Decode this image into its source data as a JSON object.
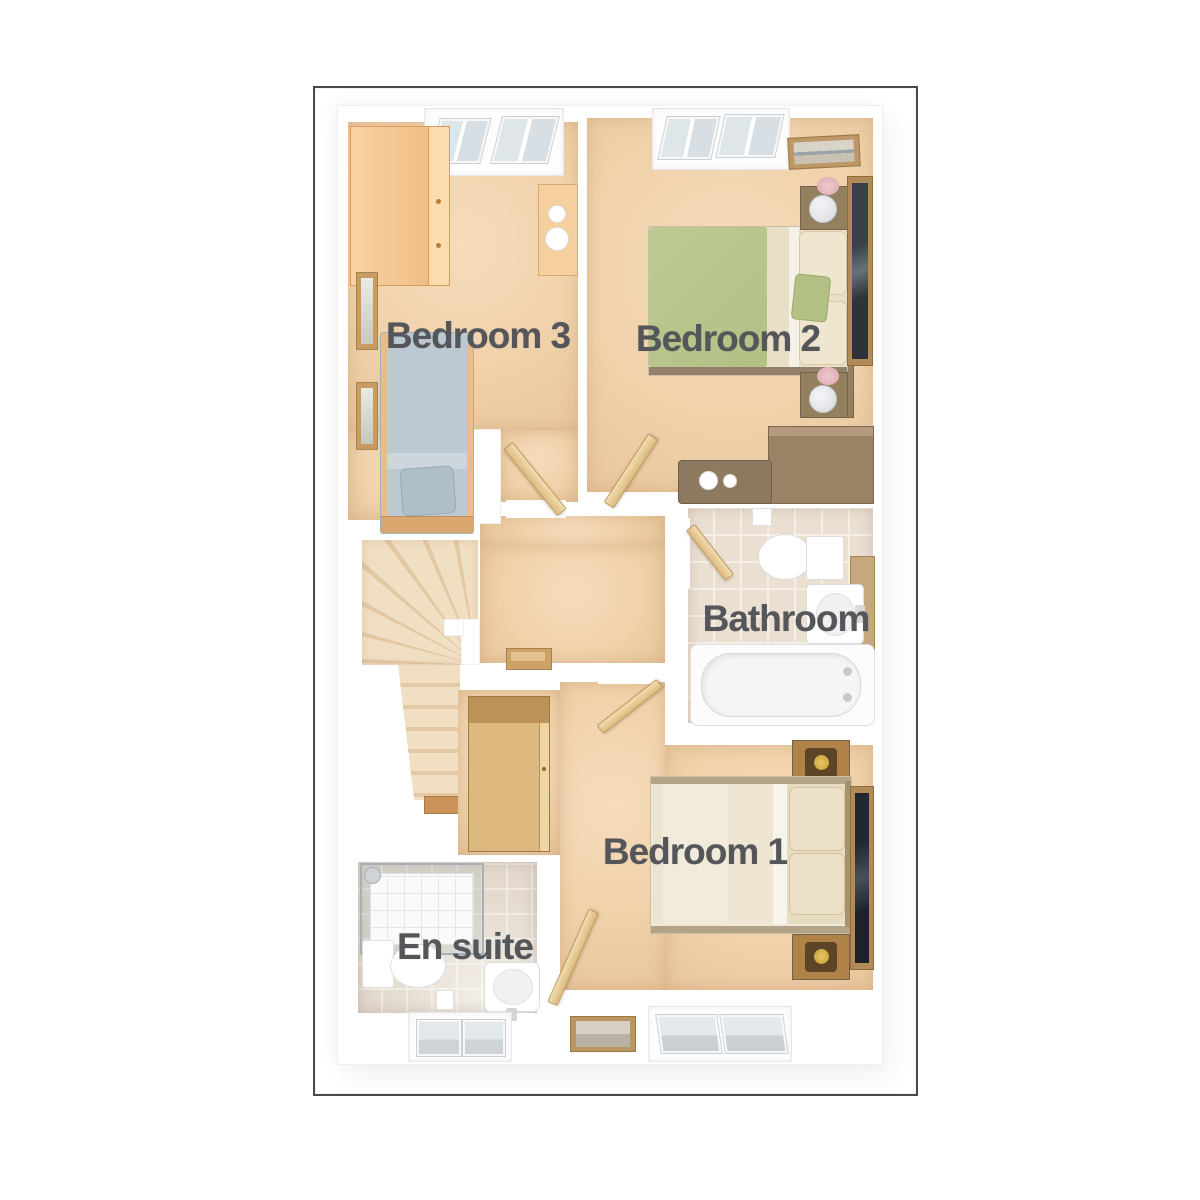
{
  "plan": {
    "type": "residential-floor-plan",
    "frame_border_color": "#4a4a4d",
    "wall_color": "#ffffff",
    "label_text_color": "#54565a"
  },
  "rooms": [
    {
      "id": "bedroom-3",
      "label": "Bedroom 3",
      "fixtures": [
        "wardrobe",
        "dressing-table",
        "single-bed",
        "window",
        "picture-frames"
      ]
    },
    {
      "id": "bedroom-2",
      "label": "Bedroom 2",
      "fixtures": [
        "double-bed",
        "bedside-tables",
        "lamps",
        "mirror",
        "desk",
        "stool",
        "window",
        "picture-frame"
      ]
    },
    {
      "id": "bathroom",
      "label": "Bathroom",
      "fixtures": [
        "toilet",
        "basin",
        "bath"
      ]
    },
    {
      "id": "bedroom-1",
      "label": "Bedroom 1",
      "fixtures": [
        "double-bed",
        "bedside-tables",
        "lamps",
        "mirror",
        "wardrobe-cabinet",
        "window",
        "picture-frame"
      ]
    },
    {
      "id": "en-suite",
      "label": "En suite",
      "fixtures": [
        "shower",
        "toilet",
        "basin",
        "window"
      ]
    }
  ],
  "circulation": [
    "landing",
    "staircase-with-winders",
    "newel-post"
  ],
  "colors": {
    "carpet": "#f2d4ae",
    "stairs": "#ecd8b8",
    "bathroom_tile": "#ebdfd2",
    "ensuite_tile": "#e3d9cc",
    "light_wood": "#f3c48f",
    "mid_wood": "#d9b27c",
    "dark_wood": "#92805f",
    "door_wood": "#e9cf9f",
    "bed2_duvet_green": "#b9c78d",
    "bed3_duvet_blue": "#bdc9d2",
    "bed1_duvet_cream": "#f0e9da"
  }
}
